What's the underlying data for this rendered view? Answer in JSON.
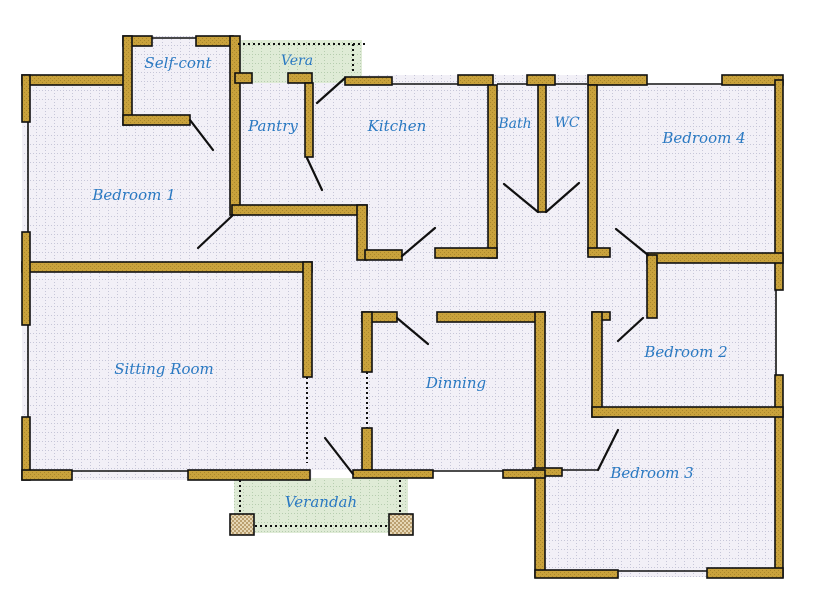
{
  "plan": {
    "title": "House floor plan",
    "rooms": [
      {
        "label": "Self-cont"
      },
      {
        "label": "Vera"
      },
      {
        "label": "Pantry"
      },
      {
        "label": "Kitchen"
      },
      {
        "label": "Bath"
      },
      {
        "label": "WC"
      },
      {
        "label": "Bedroom 4"
      },
      {
        "label": "Bedroom 1"
      },
      {
        "label": "Sitting Room"
      },
      {
        "label": "Dinning"
      },
      {
        "label": "Bedroom 2"
      },
      {
        "label": "Bedroom 3"
      },
      {
        "label": "Verandah"
      }
    ]
  },
  "colors": {
    "background": "#FFFFFF",
    "wall": "#C9A23C",
    "wall_shade": "#AA872C",
    "floor": "#F2F0F7",
    "floor_dot": "#C6C6D8",
    "porch": "#DFEBD6",
    "porch_dot": "#B6CDAF",
    "pillar": "#E6D7B5",
    "pillar_shade": "#BBA070",
    "label": "#2A79C2",
    "outline": "#101010"
  }
}
